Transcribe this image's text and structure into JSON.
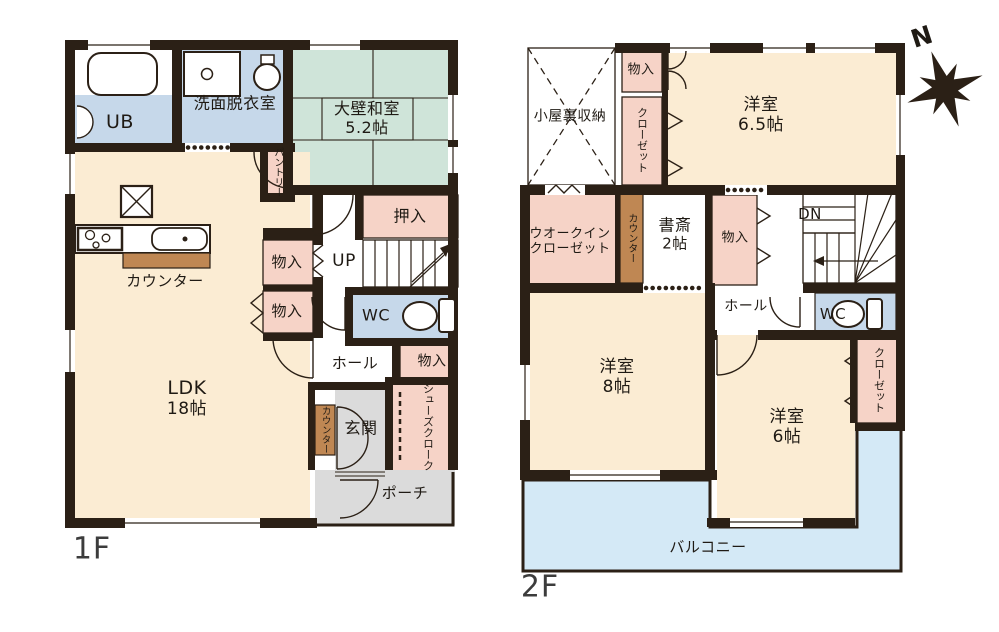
{
  "compass": {
    "label": "N"
  },
  "colors": {
    "wall": "#2b2016",
    "room_cream": "#fbecd3",
    "room_green": "#cfe4d9",
    "room_blue": "#c6d8ea",
    "room_pink": "#f6d3c7",
    "counter_brown": "#bf8753",
    "floor_gray": "#dbdbdb",
    "balcony_blue": "#d4e9f6"
  },
  "floor1": {
    "label": "1F",
    "rooms": {
      "ub": {
        "label": "UB"
      },
      "senmen": {
        "label": "洗面脱衣室"
      },
      "washitsu": {
        "label": "大壁和室",
        "size": "5.2帖"
      },
      "pantry": {
        "label": "パントリー"
      },
      "oshiire": {
        "label": "押入"
      },
      "up": {
        "label": "UP"
      },
      "monoire_a": {
        "label": "物入"
      },
      "monoire_b": {
        "label": "物入"
      },
      "monoire_c": {
        "label": "物入"
      },
      "wc": {
        "label": "WC"
      },
      "hall": {
        "label": "ホール"
      },
      "ldk": {
        "label": "LDK",
        "size": "18帖"
      },
      "counter_kitchen": {
        "label": "カウンター"
      },
      "counter_entry": {
        "label": "カウンター"
      },
      "genkan": {
        "label": "玄関"
      },
      "shoes_cloak": {
        "label": "シューズクローク"
      },
      "porch": {
        "label": "ポーチ"
      }
    }
  },
  "floor2": {
    "label": "2F",
    "rooms": {
      "attic": {
        "label": "小屋裏収納"
      },
      "monoire_top": {
        "label": "物入"
      },
      "closet_top": {
        "label": "クローゼット"
      },
      "yoshitsu_65": {
        "label": "洋室",
        "size": "6.5帖"
      },
      "wic": {
        "label": "ウオークイン",
        "label2": "クローゼット"
      },
      "counter": {
        "label": "カウンター"
      },
      "shosai": {
        "label": "書斎",
        "size": "2帖"
      },
      "monoire_mid": {
        "label": "物入"
      },
      "dn": {
        "label": "DN"
      },
      "hall": {
        "label": "ホール"
      },
      "wc": {
        "label": "WC"
      },
      "yoshitsu_8": {
        "label": "洋室",
        "size": "8帖"
      },
      "yoshitsu_6": {
        "label": "洋室",
        "size": "6帖"
      },
      "closet_se": {
        "label": "クローゼット"
      },
      "balcony": {
        "label": "バルコニー"
      }
    }
  }
}
